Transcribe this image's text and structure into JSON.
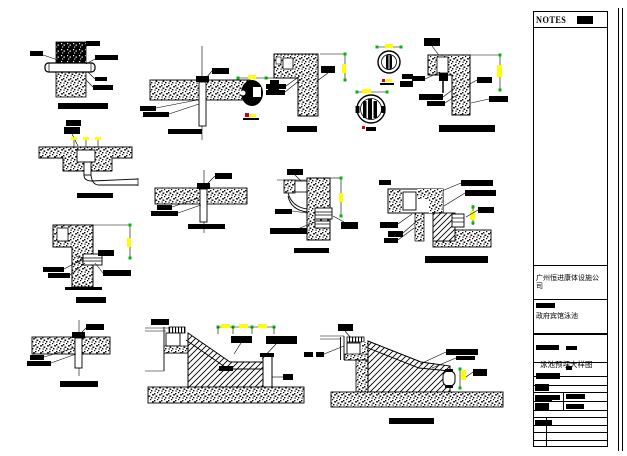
{
  "notes_panel": {
    "header": "NOTES"
  },
  "title_block": {
    "company": "广州恒进康体设施公司",
    "project_name": "政府宾馆泳池",
    "drawing_title": "泳池预埋大样图"
  },
  "colors": {
    "paper": "#ffffff",
    "ink": "#000000",
    "dimension_tick_yellow": "#ffff00",
    "dimension_end_green": "#00b800",
    "level_marker_red": "#d40000"
  },
  "details": [
    "pipe-through-wall-penetration",
    "pipe-through-floor-penetration-a",
    "escutcheon-section-plan",
    "pool-wall-corner-a",
    "fitting-plan-view-circles",
    "pool-wall-corner-b",
    "floor-niche-with-drain-elbow",
    "pipe-through-floor-penetration-b",
    "wall-inlet-fitting-section",
    "overflow-gutter-corner-section",
    "pool-wall-corner-c",
    "pipe-through-floor-penetration-c",
    "pool-edge-gutter-section-a",
    "pool-edge-gutter-section-b"
  ]
}
